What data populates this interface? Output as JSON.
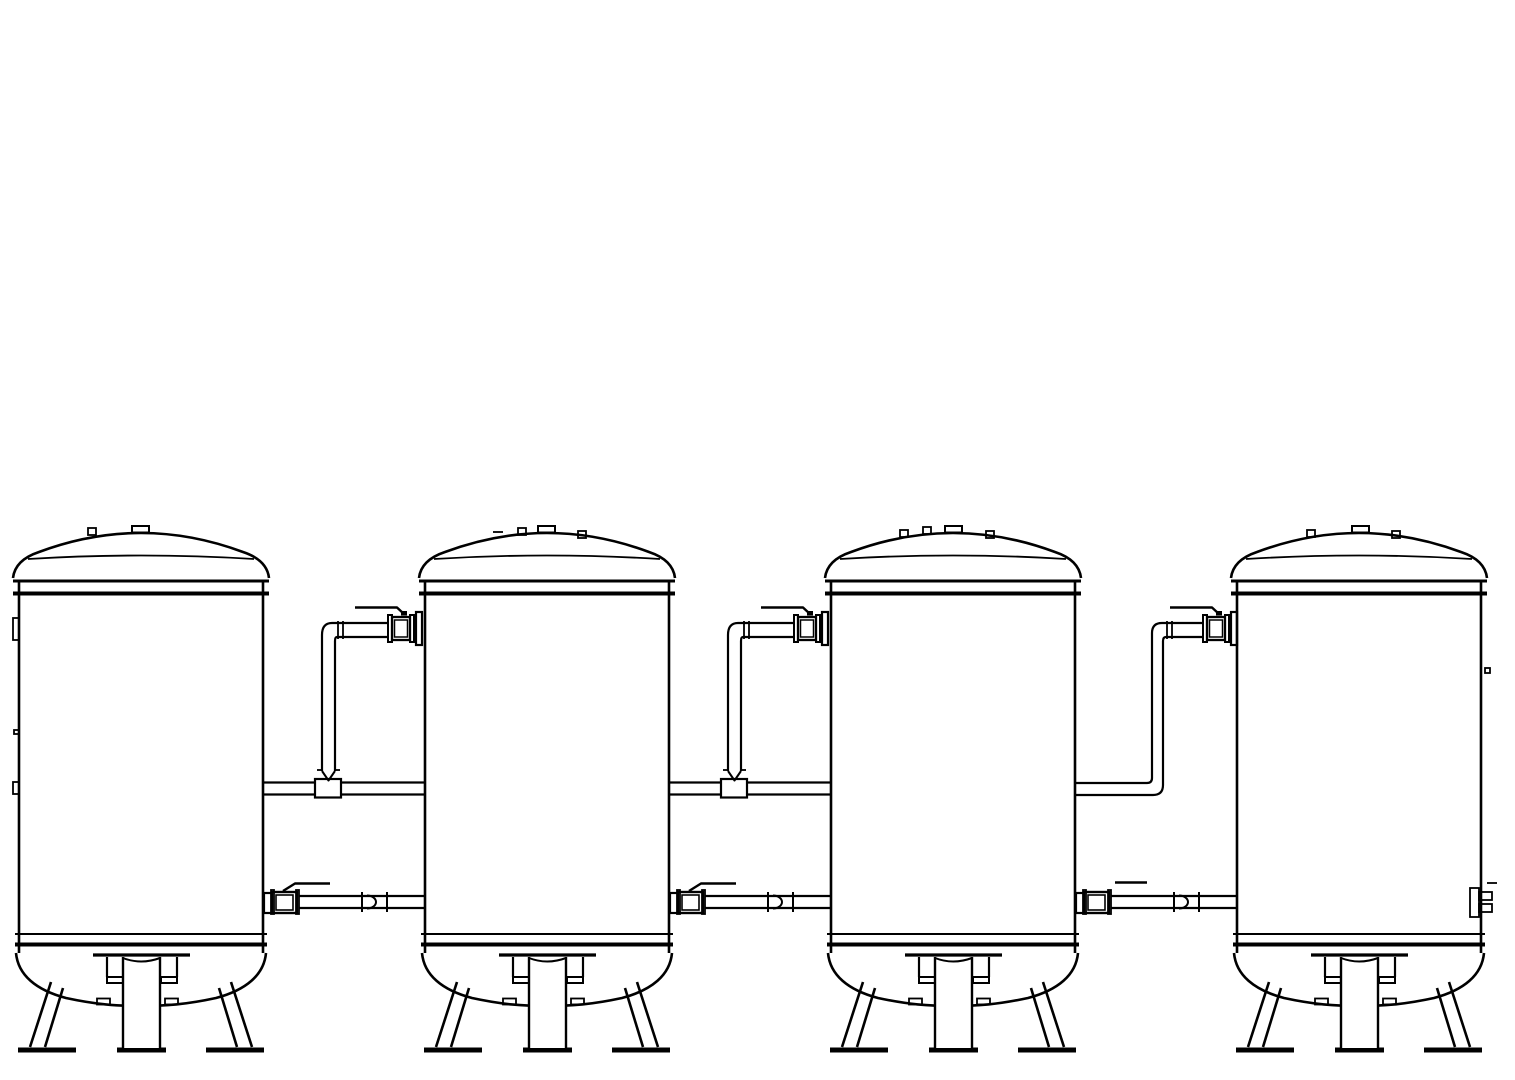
{
  "drawing": {
    "background": "#ffffff",
    "line_color": "#000000",
    "canvas_width": 1515,
    "canvas_height": 1080,
    "tank_width": 244,
    "tanks": [
      {
        "id": 1,
        "x": 19,
        "nozzles": [
          {
            "type": "small",
            "dx": 69,
            "y": 528
          },
          {
            "type": "flanged",
            "dx": 113,
            "y": 526
          }
        ],
        "fittings": [
          {
            "kind": "wall-stub",
            "x": 13,
            "y": 618,
            "w": 6,
            "h": 22
          },
          {
            "kind": "wall-tick",
            "x": 14,
            "y": 730,
            "w": 5,
            "h": 4
          },
          {
            "kind": "wall-stub",
            "x": 13,
            "y": 782,
            "w": 6,
            "h": 12
          }
        ]
      },
      {
        "id": 2,
        "x": 425,
        "nozzles": [
          {
            "type": "dash",
            "dx": 68,
            "y": 532
          },
          {
            "type": "small",
            "dx": 93,
            "y": 528
          },
          {
            "type": "flanged",
            "dx": 113,
            "y": 526
          },
          {
            "type": "small",
            "dx": 153,
            "y": 531
          }
        ],
        "fittings": []
      },
      {
        "id": 3,
        "x": 831,
        "nozzles": [
          {
            "type": "small",
            "dx": 69,
            "y": 530
          },
          {
            "type": "small",
            "dx": 92,
            "y": 527
          },
          {
            "type": "flanged",
            "dx": 114,
            "y": 526
          },
          {
            "type": "small",
            "dx": 155,
            "y": 531
          }
        ],
        "fittings": []
      },
      {
        "id": 4,
        "x": 1237,
        "nozzles": [
          {
            "type": "small",
            "dx": 70,
            "y": 530
          },
          {
            "type": "flanged",
            "dx": 115,
            "y": 526
          },
          {
            "type": "small",
            "dx": 155,
            "y": 531
          }
        ],
        "fittings": [
          {
            "kind": "wall-tick",
            "x": 1485,
            "y": 668,
            "w": 5,
            "h": 5
          },
          {
            "kind": "drain-flange",
            "x": 1470,
            "y": 888,
            "w": 9,
            "h": 29
          },
          {
            "kind": "drain-stub",
            "x": 1479,
            "y": 892,
            "w": 13,
            "h": 8
          },
          {
            "kind": "drain-stub",
            "x": 1479,
            "y": 904,
            "w": 13,
            "h": 8
          },
          {
            "kind": "drain-dash",
            "x": 1487,
            "y": 883,
            "w": 10,
            "h": 0
          }
        ]
      }
    ],
    "upper_pipe_runs": [
      {
        "style": "tee-drop",
        "left_wall": 263,
        "right_wall": 425
      },
      {
        "style": "tee-drop",
        "left_wall": 669,
        "right_wall": 831
      },
      {
        "style": "elbow-drop",
        "left_wall": 1075,
        "right_wall": 1237
      }
    ],
    "lower_pipe_runs": [
      {
        "left_wall": 263,
        "right_wall": 425,
        "handle": "angled"
      },
      {
        "left_wall": 669,
        "right_wall": 831,
        "handle": "angled"
      },
      {
        "left_wall": 1075,
        "right_wall": 1237,
        "handle": "straight"
      }
    ]
  }
}
